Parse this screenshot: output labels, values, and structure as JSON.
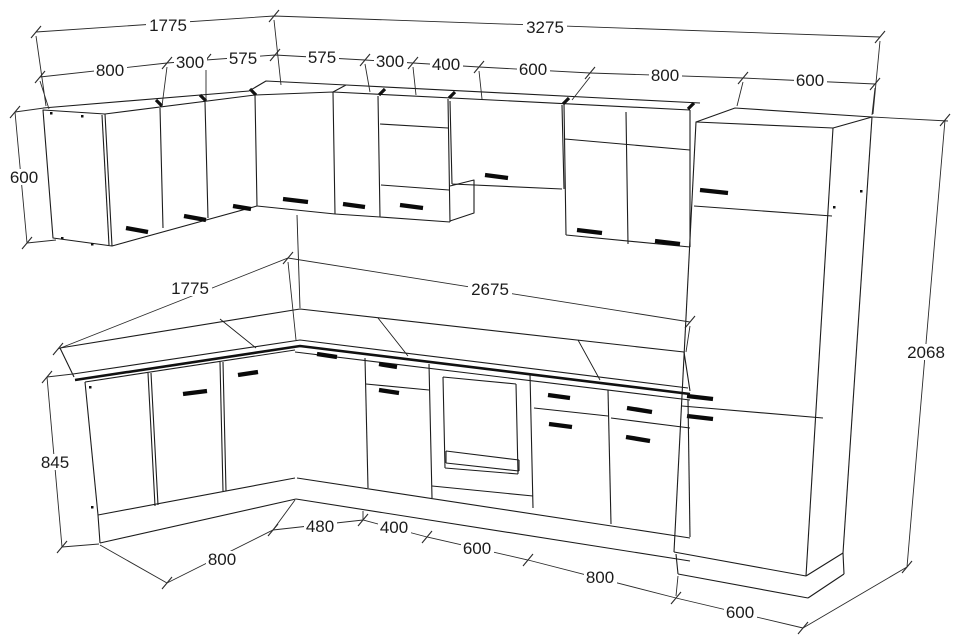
{
  "drawing": {
    "title": "L-shaped kitchen perspective drawing",
    "units": "mm",
    "colors": {
      "line": "#1c1c1c",
      "handle": "#0a0a0a",
      "background": "#ffffff"
    }
  },
  "dims": {
    "wallTotalLeft": "1775",
    "wallTotalRight": "3275",
    "wallRow": [
      "800",
      "300",
      "575",
      "575",
      "300",
      "400",
      "600",
      "800",
      "600"
    ],
    "wallHeight": "600",
    "counterLeft": "1775",
    "counterRight": "2675",
    "baseHeight": "845",
    "totalHeight": "2068",
    "baseRow": [
      "800",
      "480",
      "400",
      "600",
      "800",
      "600"
    ]
  }
}
